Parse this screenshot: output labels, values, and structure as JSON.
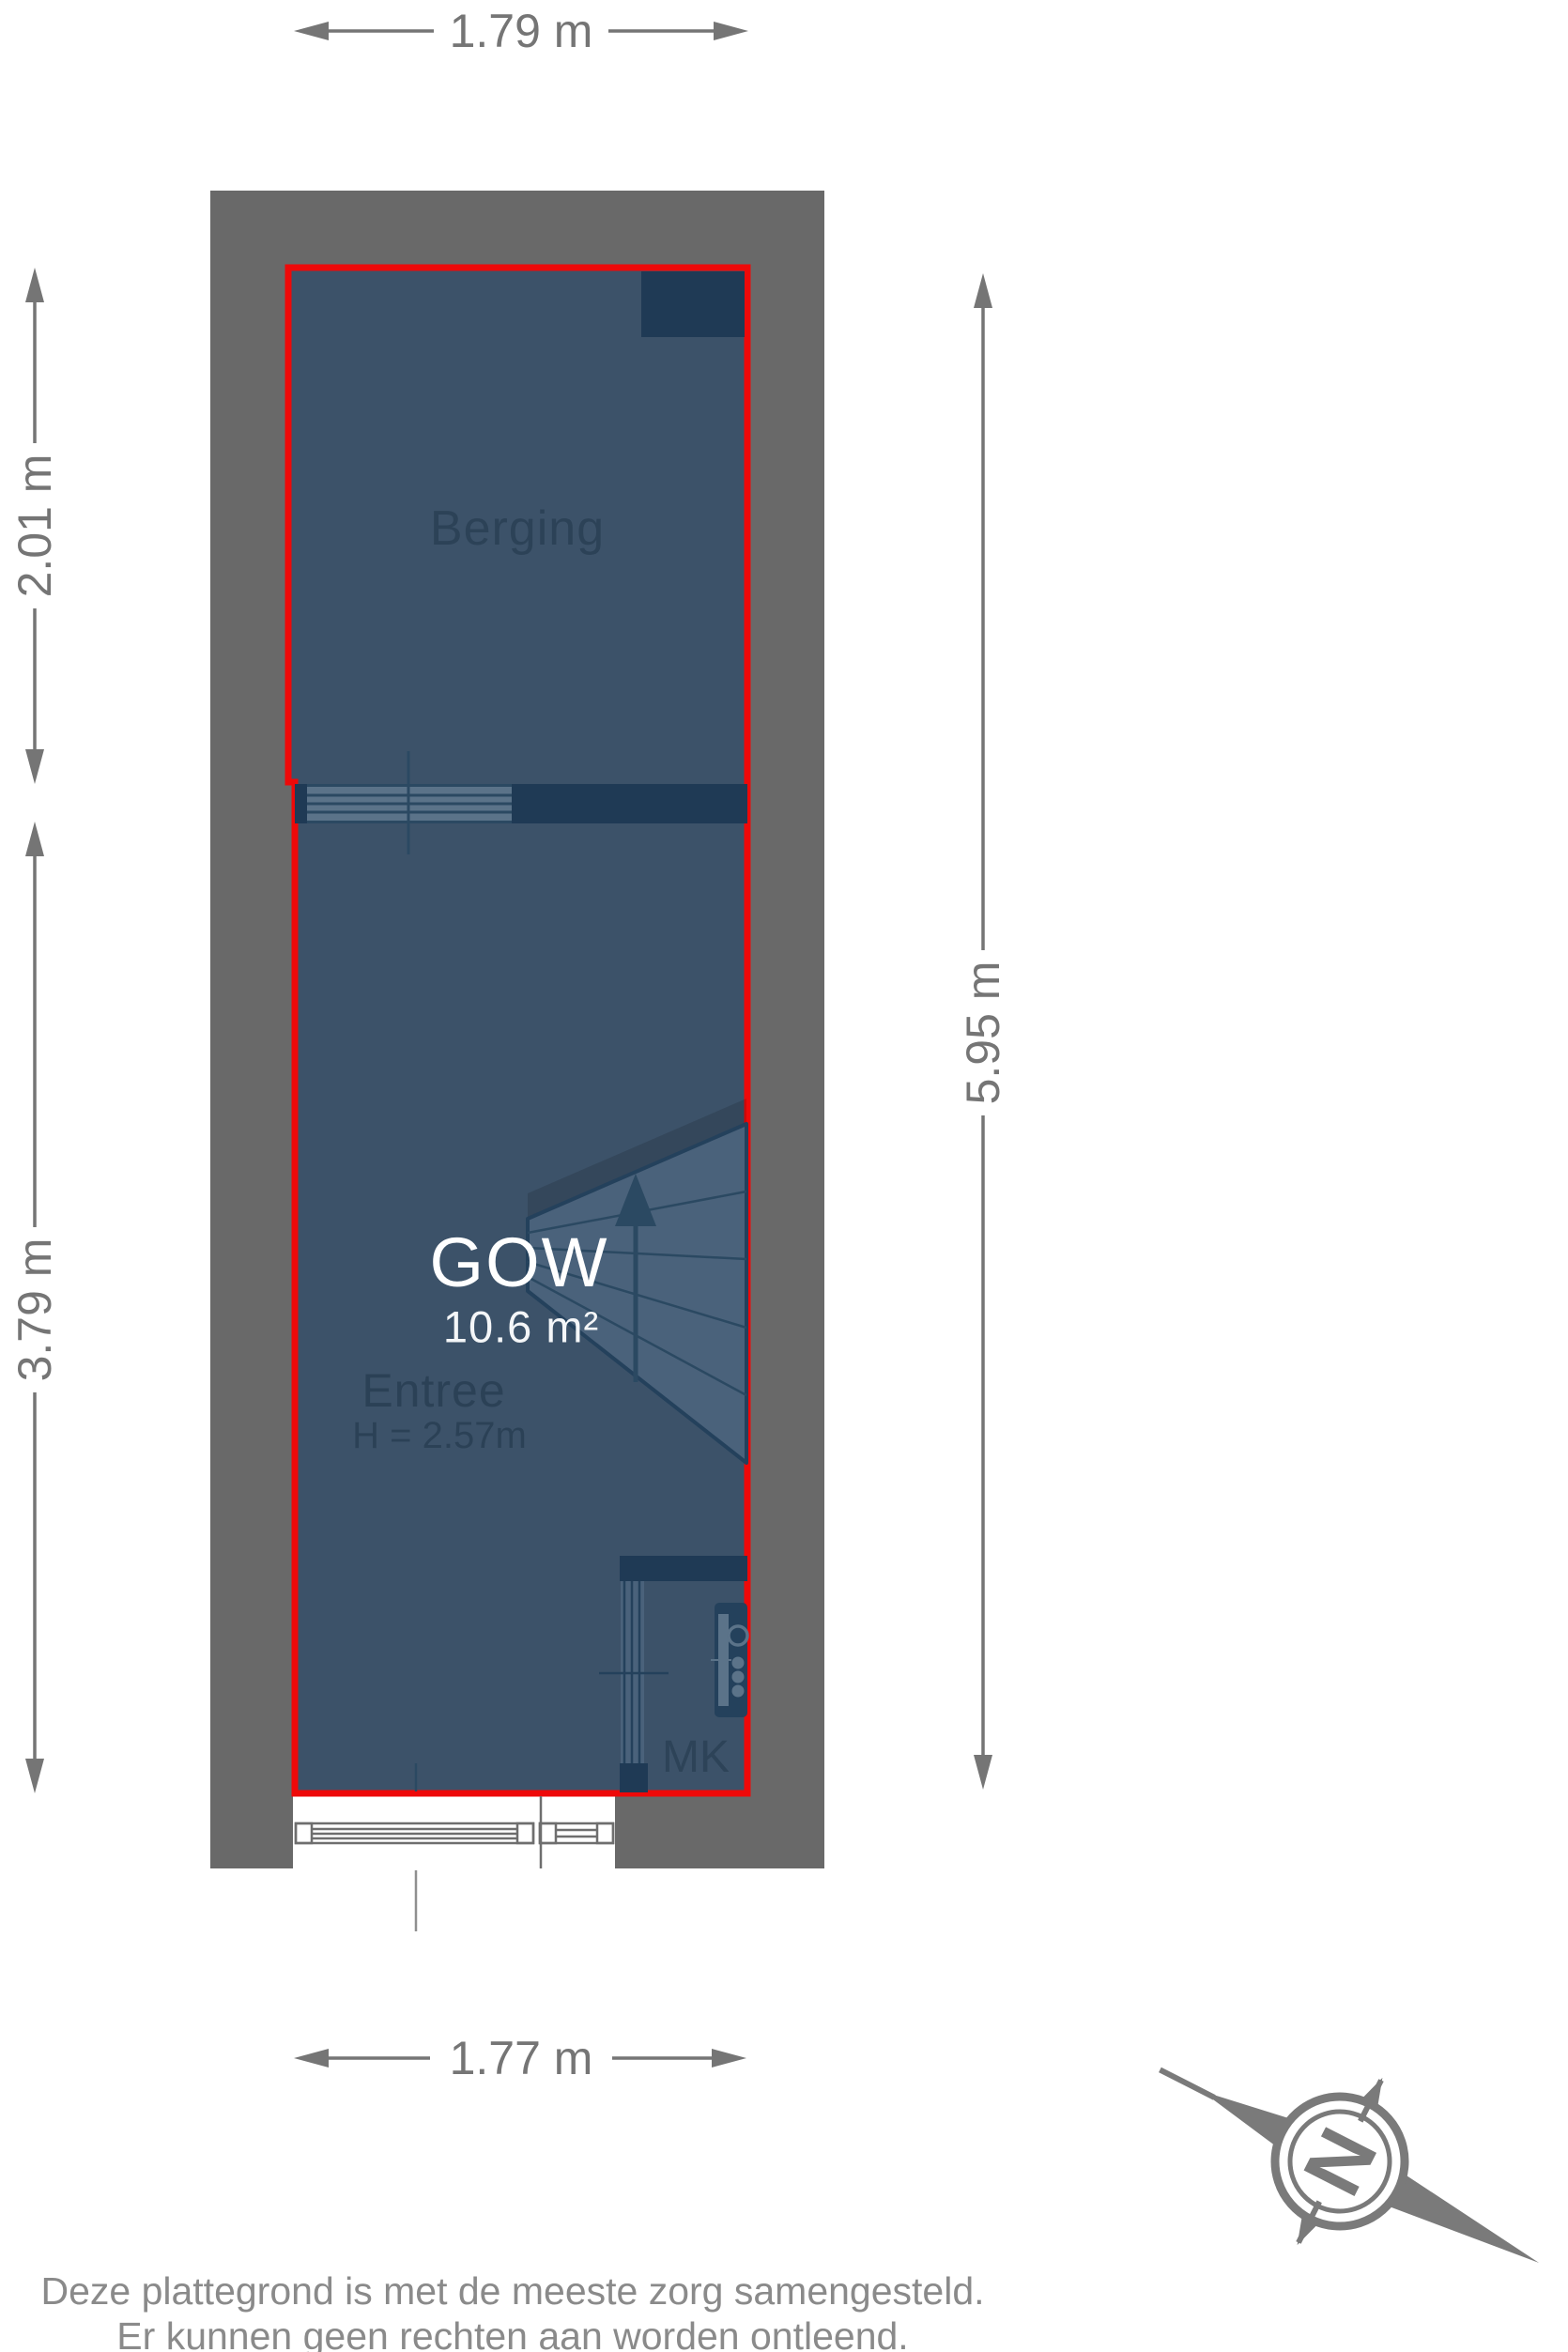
{
  "dimensions": {
    "top": "1.79 m",
    "left_upper": "2.01 m",
    "left_lower": "3.79 m",
    "right": "5.95 m",
    "bottom": "1.77 m"
  },
  "rooms": {
    "berging": {
      "label": "Berging"
    },
    "gow": {
      "label": "GOW",
      "area": "10.6 m²"
    },
    "entree": {
      "label": "Entree",
      "ceiling_height": "H = 2.57m"
    },
    "mk": {
      "label": "MK"
    }
  },
  "compass": {
    "north_label": "N"
  },
  "footer": {
    "line1": "Deze plattegrond is met de meeste zorg samengesteld.",
    "line2": "Er kunnen geen rechten aan worden ontleend."
  },
  "colors": {
    "wall_gray": "#696969",
    "floor_blue": "#3c5269",
    "dark_wall_navy": "#1f3a55",
    "stair_fill": "#4a627b",
    "plan_outline_red": "#ee0909",
    "dimension_gray": "#757575",
    "label_navy": "#2b4156",
    "footer_gray": "#8a8a8a",
    "compass_gray": "#7a7a7a",
    "white_text": "#ffffff"
  }
}
